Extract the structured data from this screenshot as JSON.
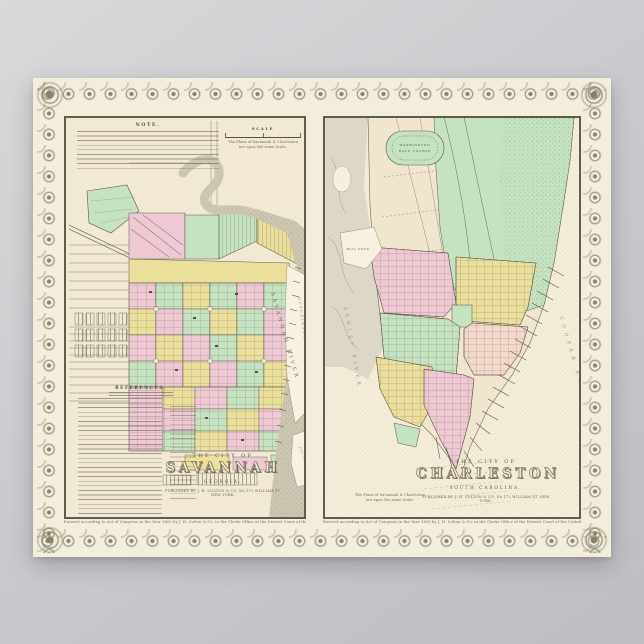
{
  "scene": {
    "background": "#cbcbcf"
  },
  "poster": {
    "paper": "#f3eddb",
    "ink": "#4e4a3c",
    "border_ink": "#8d8773",
    "ward_pink": "#eec9d4",
    "ward_yellow": "#ebdf9c",
    "ward_green": "#c5e2c1",
    "water_gray": "#cbc5b2",
    "savannah": {
      "note_title": "NOTE.",
      "scale_title": "SCALE",
      "scale_caption_line1": "The Plans of Savannah & Charleston",
      "scale_caption_line2": "are upon the same Scale.",
      "references_title": "REFERENCES.",
      "title_prefix": "THE CITY OF",
      "title": "SAVANNAH",
      "region": "GEORGIA.",
      "publisher": "PUBLISHED BY J. H. COLTON & CO. No.172 WILLIAM ST. NEW YORK.",
      "river_label": "SAVANNAH RIVER",
      "island_label": "HUTCHINSON ISLAND",
      "fig_island_label": "FIG ISLAND",
      "copyright": "Entered according to Act of Congress in the Year 1855 by J. H. Colton & Co. in the Clerks Office of the District Court of the United States for the Southern District of New York."
    },
    "charleston": {
      "title_prefix": "THE CITY OF",
      "title": "CHARLESTON",
      "region": "SOUTH CAROLINA.",
      "publisher": "PUBLISHED BY J. H. COLTON & CO. No.172 WILLIAM ST. NEW YORK.",
      "note_line1": "The Plans of Savannah & Charleston",
      "note_line2": "are upon the same Scale.",
      "race_course_line1": "WASHINGTON",
      "race_course_line2": "RACE COURSE",
      "mill_pond_label": "MILL POND",
      "ashley_label": "ASHLEY RIVER",
      "cooper_label": "COOPER RIVER",
      "copyright": "Entered according to Act of Congress in the Year 1855 by J. H. Colton & Co. in the Clerks Office of the District Court of the United States for the Southern District of New York."
    }
  }
}
